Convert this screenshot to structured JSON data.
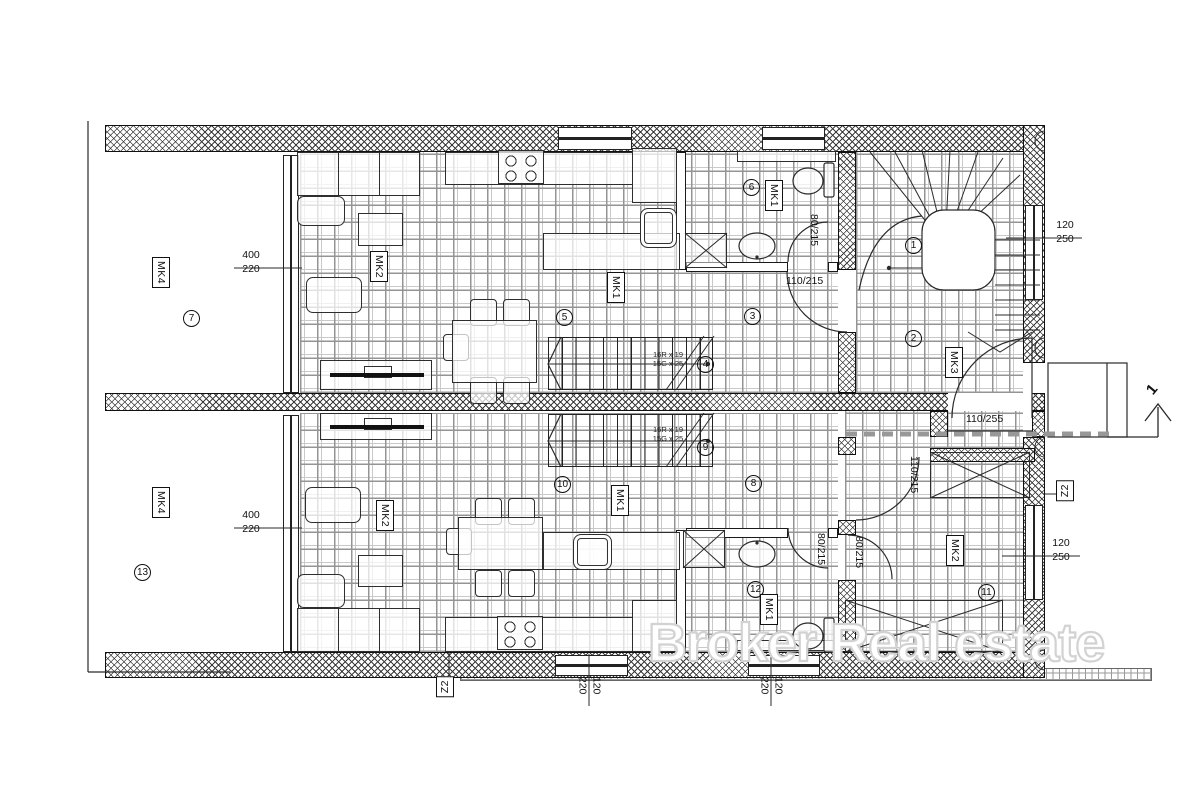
{
  "watermark": "Broker Real estate",
  "annotations": {
    "circled_rooms": [
      {
        "n": "1",
        "x": 905,
        "y": 237
      },
      {
        "n": "2",
        "x": 905,
        "y": 330
      },
      {
        "n": "3",
        "x": 744,
        "y": 308
      },
      {
        "n": "4",
        "x": 697,
        "y": 356
      },
      {
        "n": "5",
        "x": 556,
        "y": 309
      },
      {
        "n": "6",
        "x": 743,
        "y": 179
      },
      {
        "n": "7",
        "x": 183,
        "y": 310
      },
      {
        "n": "8",
        "x": 745,
        "y": 475
      },
      {
        "n": "9",
        "x": 697,
        "y": 439
      },
      {
        "n": "10",
        "x": 554,
        "y": 476
      },
      {
        "n": "11",
        "x": 978,
        "y": 584
      },
      {
        "n": "12",
        "x": 747,
        "y": 581
      },
      {
        "n": "13",
        "x": 134,
        "y": 564
      }
    ],
    "boxed_labels": [
      {
        "t": "MK4",
        "x": 152,
        "y": 257,
        "o": "v"
      },
      {
        "t": "MK4",
        "x": 152,
        "y": 487,
        "o": "v"
      },
      {
        "t": "MK2",
        "x": 370,
        "y": 251,
        "o": "v"
      },
      {
        "t": "MK2",
        "x": 376,
        "y": 500,
        "o": "v"
      },
      {
        "t": "MK1",
        "x": 607,
        "y": 272,
        "o": "v"
      },
      {
        "t": "MK1",
        "x": 765,
        "y": 180,
        "o": "v"
      },
      {
        "t": "MK1",
        "x": 611,
        "y": 485,
        "o": "v"
      },
      {
        "t": "MK1",
        "x": 760,
        "y": 594,
        "o": "v"
      },
      {
        "t": "MK3",
        "x": 945,
        "y": 347,
        "o": "v"
      },
      {
        "t": "MK2",
        "x": 946,
        "y": 535,
        "o": "v"
      },
      {
        "t": "Z2",
        "x": 436,
        "y": 676,
        "o": "ccw"
      },
      {
        "t": "Z2",
        "x": 1056,
        "y": 480,
        "o": "ccw"
      }
    ],
    "door_dims": [
      {
        "t": "110/255",
        "x": 966,
        "y": 413,
        "o": "h"
      },
      {
        "t": "110/215",
        "x": 786,
        "y": 275,
        "o": "h"
      },
      {
        "t": "80/215",
        "x": 808,
        "y": 214,
        "o": "v"
      },
      {
        "t": "80/215",
        "x": 815,
        "y": 533,
        "o": "v"
      },
      {
        "t": "80/215",
        "x": 853,
        "y": 536,
        "o": "v"
      },
      {
        "t": "110/215",
        "x": 908,
        "y": 456,
        "o": "v"
      }
    ],
    "window_dims": [
      {
        "t": "400",
        "b": "220",
        "x": 234,
        "y": 249,
        "o": "h"
      },
      {
        "t": "400",
        "b": "220",
        "x": 234,
        "y": 509,
        "o": "h"
      },
      {
        "t": "120",
        "b": "250",
        "x": 1048,
        "y": 219,
        "o": "h"
      },
      {
        "t": "120",
        "b": "250",
        "x": 1044,
        "y": 537,
        "o": "h"
      },
      {
        "t": "120",
        "b": "220",
        "x": 572,
        "y": 672,
        "o": "rot"
      },
      {
        "t": "120",
        "b": "220",
        "x": 754,
        "y": 672,
        "o": "rot"
      }
    ],
    "stair_specs": [
      {
        "l1": "16R x 19",
        "l2": "15G x 25",
        "x": 636,
        "y": 350
      },
      {
        "l1": "16R x 19",
        "l2": "15G x 25",
        "x": 636,
        "y": 425
      }
    ],
    "entrance_marker": {
      "t": "1",
      "x": 1148,
      "y": 381
    }
  }
}
